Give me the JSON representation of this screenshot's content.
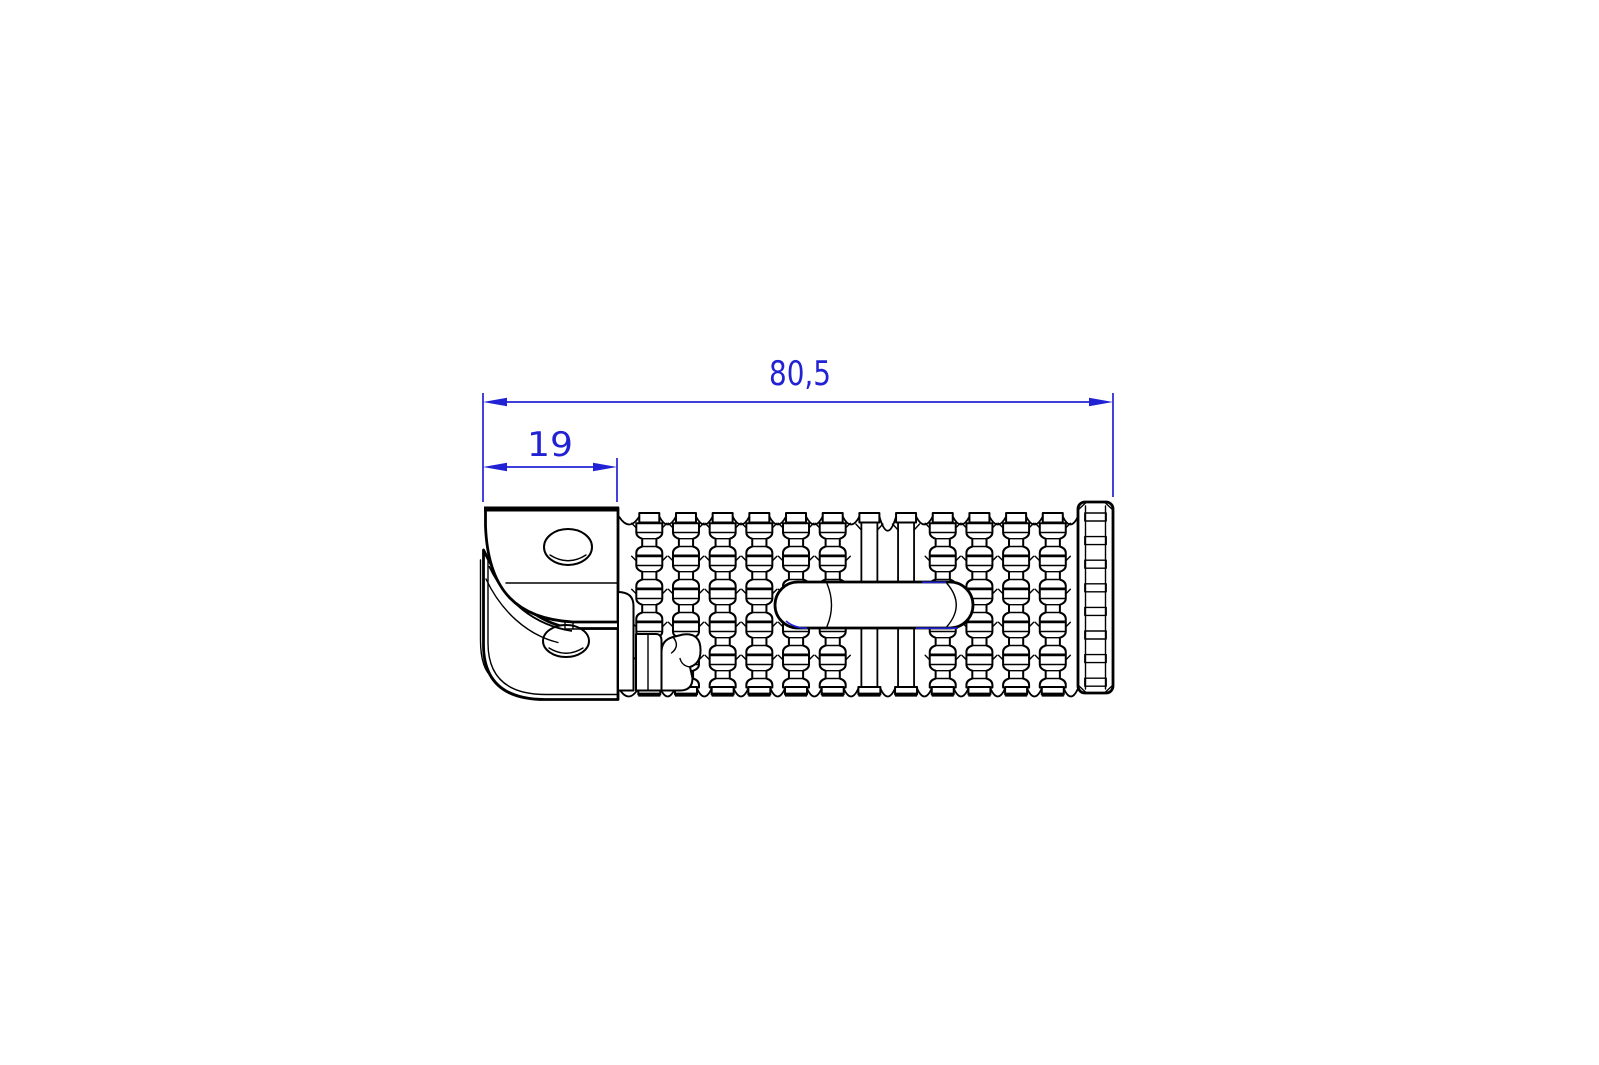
{
  "page": {
    "background_color": "#ffffff"
  },
  "palette": {
    "dimension_color": "#2222d5",
    "line_color": "#000000"
  },
  "dimensions": {
    "overall_length": {
      "label": "80,5",
      "value": 80.5
    },
    "bracket_width": {
      "label": "19",
      "value": 19
    }
  }
}
